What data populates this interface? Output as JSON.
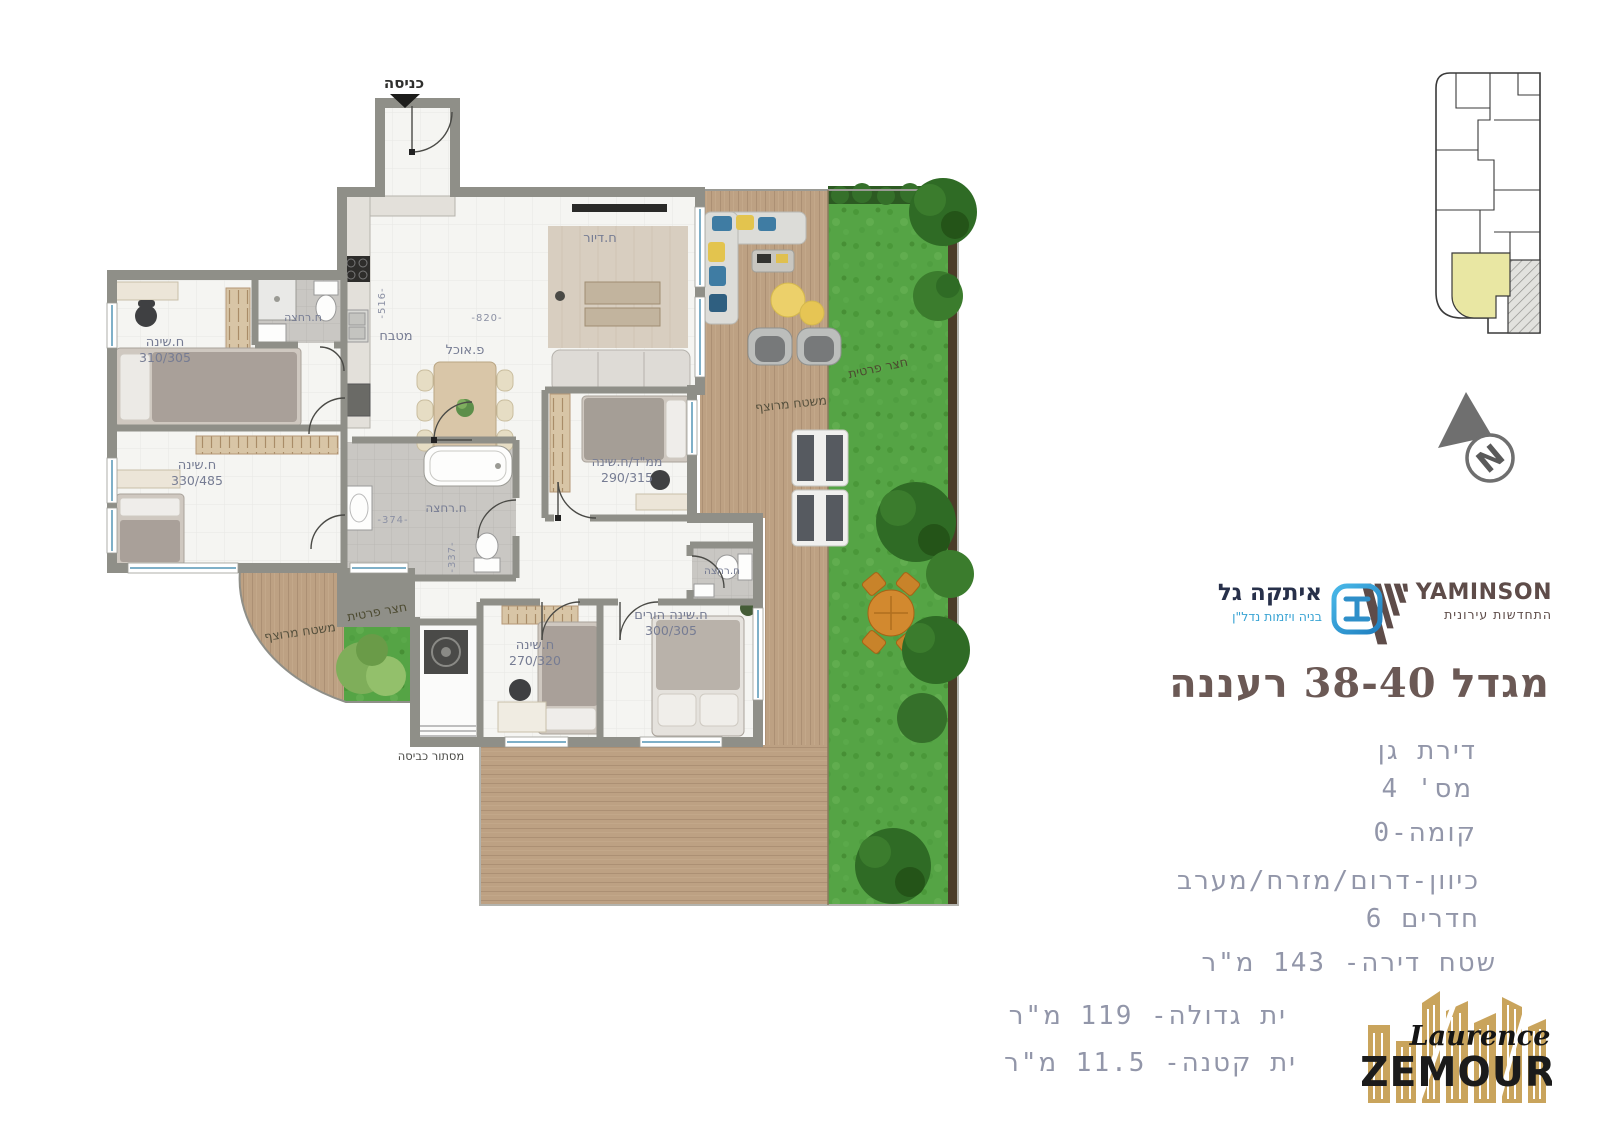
{
  "title": "מגדל 38-40 רעננה",
  "logos": {
    "yaminson": {
      "name": "YAMINSON",
      "tagline": "התחדשות עירונית"
    },
    "itaka": {
      "name": "איתקה גל",
      "tagline": "בניה ויזמות נדל\"ן"
    },
    "zemour": {
      "first_name": "Laurence",
      "last_name": "ZEMOUR"
    }
  },
  "details": {
    "lines": [
      "דירת גן",
      "מס' 4",
      "קומה-0",
      "כיוון-דרום/מזרח/מערב",
      "חדרים 6",
      "שטח דירה- 143 מ\"ר",
      "ית גדולה- 119 מ\"ר",
      "ית קטנה- 11.5 מ\"ר"
    ]
  },
  "plan": {
    "entrance": "כניסה",
    "bedroom1": {
      "name": "ח.שינה",
      "size": "310/305"
    },
    "bedroom2": {
      "name": "ח.שינה",
      "size": "330/485"
    },
    "bedroom3": {
      "name": "ח.שינה",
      "size": "270/320"
    },
    "parents": {
      "name": "ח.שינה הורים",
      "size": "300/305"
    },
    "mamad": {
      "name": "ממ\"ד/ח.שינה",
      "size": "290/315"
    },
    "bath1": "ח.רחצה",
    "bath2": "ח.רחצה",
    "bath3": "ח.רחצה",
    "kitchen": "מטבח",
    "dining": "פ.אוכל",
    "living": "ח.דיור",
    "laundry": "מסתור כביסה",
    "outdoor": {
      "deck": "משטח מרוצף",
      "garden": "חצר פרטית",
      "small_deck": "משטח מרוצף",
      "small_garden": "חצר פרטית"
    },
    "dims": {
      "d516": "-516-",
      "d820": "-820-",
      "d374": "-374-",
      "d337": "-337-"
    },
    "north": "N"
  },
  "colors": {
    "title_brown": "#6b5955",
    "details_gray_blue": "#9296a9",
    "yaminson_maroon": "#5e4c49",
    "itaka_blue": "#2e9fd6",
    "zemour_gold": "#c9a45c",
    "keyplan_highlight": "#e9e7a3",
    "grass_green": "#55a445",
    "deck_wood": "#bb9e80"
  }
}
